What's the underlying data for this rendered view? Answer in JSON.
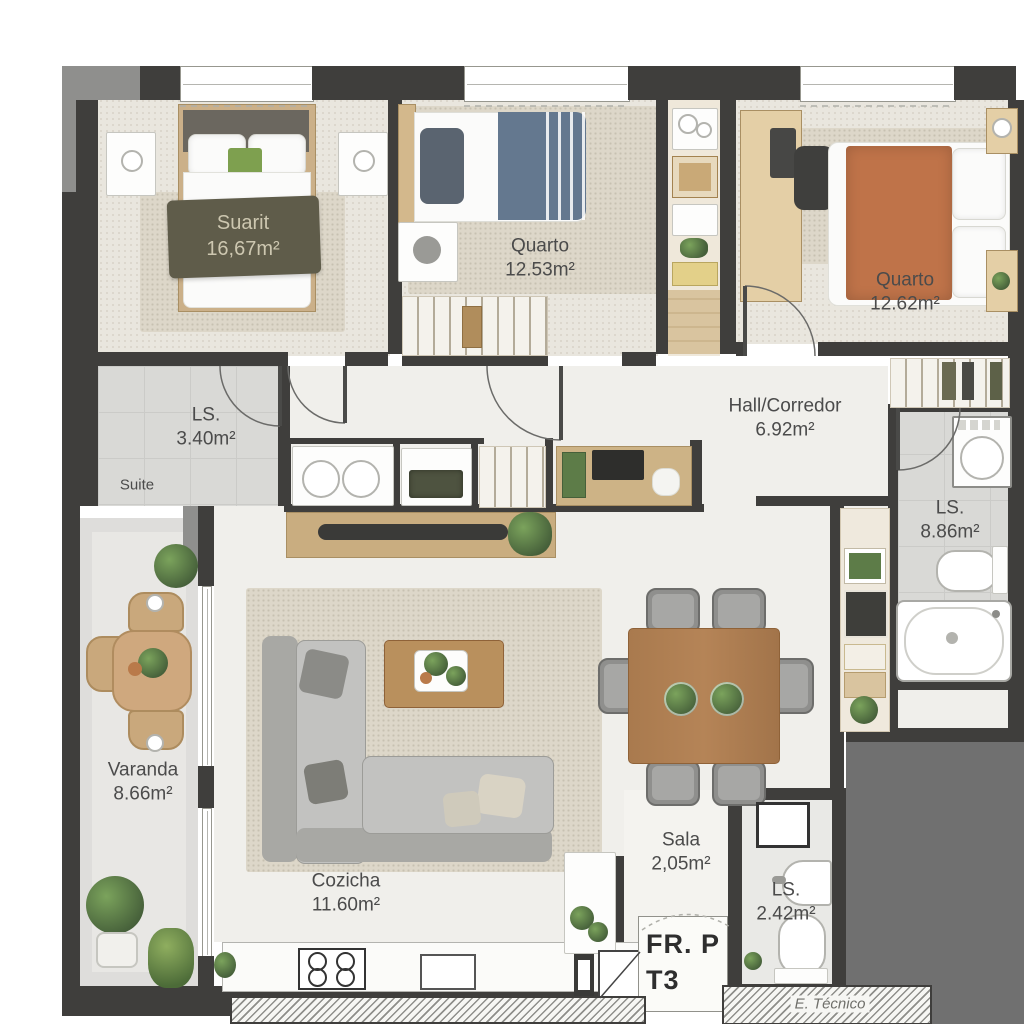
{
  "palette": {
    "wall": "#3f3e3c",
    "wall-light": "#8f8f8d",
    "slab": "#707070",
    "floor": "#f0efeb",
    "rug": "#ddd7c9",
    "wood": "#c9ad80",
    "wood-dark": "#a97a4e",
    "label": "#4b4b4b",
    "stamp": "#2e2e2e",
    "bed-orange": "#bf7349",
    "bed-blue": "#64788f",
    "blanket-olive": "#5f5c4a",
    "plant-green": "#5d7c48"
  },
  "rooms": {
    "suite": {
      "label": "Suarit",
      "area": "16,67m²"
    },
    "quarto_mid": {
      "label": "Quarto",
      "area": "12.53m²"
    },
    "quarto_right": {
      "label": "Quarto",
      "area": "12.62m²"
    },
    "hall": {
      "label": "Hall/Corredor",
      "area": "6.92m²"
    },
    "ls_suite": {
      "label": "LS.",
      "area": "3.40m²"
    },
    "suite_tag": "Suite",
    "ls_main": {
      "label": "LS.",
      "area": "8.86m²"
    },
    "varanda": {
      "label": "Varanda",
      "area": "8.66m²"
    },
    "cozinha": {
      "label": "Cozicha",
      "area": "11.60m²"
    },
    "sala": {
      "label": "Sala",
      "area": "2,05m²"
    },
    "ls_social": {
      "label": "LS.",
      "area": "2.42m²"
    },
    "tecnico": {
      "label": "E. Técnico"
    }
  },
  "stamp": {
    "line1": "FR. P",
    "line2": "T3"
  }
}
